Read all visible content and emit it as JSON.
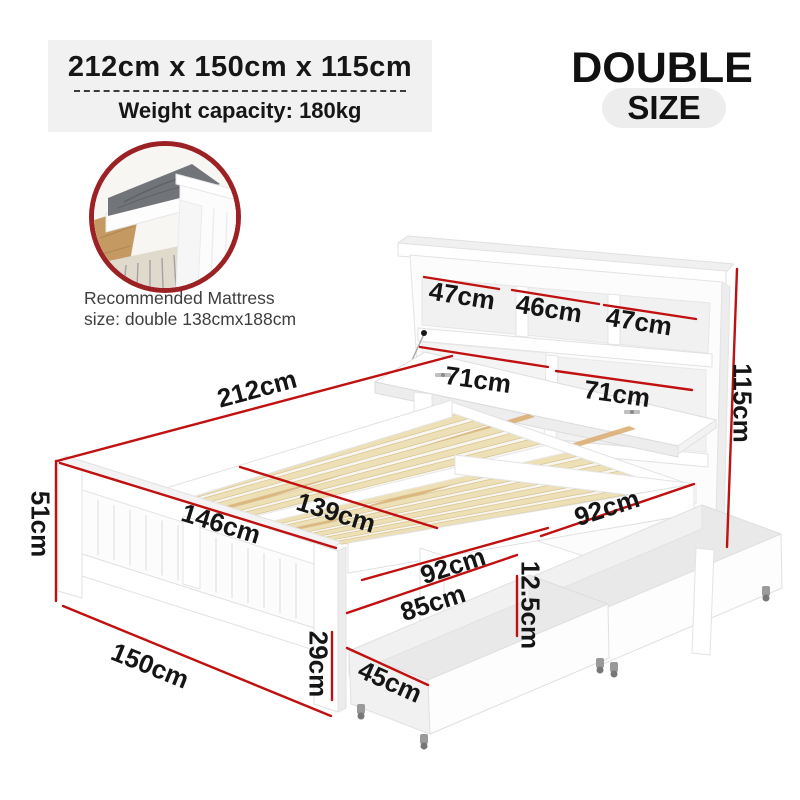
{
  "header": {
    "dimensions_title": "212cm x 150cm x 115cm",
    "weight_capacity": "Weight capacity: 180kg"
  },
  "badge": {
    "line1": "DOUBLE",
    "line2": "SIZE"
  },
  "mattress_note": {
    "line1": "Recommended Mattress",
    "line2": "size: double 138cmx188cm"
  },
  "dimensions": {
    "cubby_left": "47cm",
    "cubby_mid": "46cm",
    "cubby_right": "47cm",
    "shelf_left": "71cm",
    "shelf_right": "71cm",
    "total_height": "115cm",
    "total_length": "212cm",
    "footboard_height": "51cm",
    "footboard_width": "146cm",
    "slat_width": "139cm",
    "side_upper": "92cm",
    "side_lower": "92cm",
    "underbed_length": "85cm",
    "rail_gap": "12.5cm",
    "leg_height": "29cm",
    "total_width": "150cm",
    "drawer_width": "45cm"
  },
  "colors": {
    "accent": "#c01010",
    "circle_border": "#9c2125"
  }
}
